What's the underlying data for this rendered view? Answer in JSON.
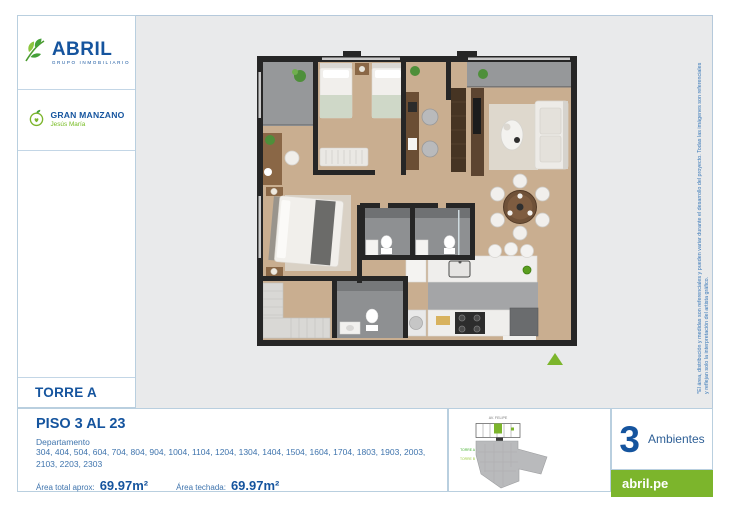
{
  "brand": {
    "name": "ABRIL",
    "tagline": "GRUPO INMOBILIARIO"
  },
  "project": {
    "name": "GRAN MANZANO",
    "district": "Jesús María"
  },
  "tower_label": "TORRE A",
  "unit": {
    "floors": "PISO 3 AL 23",
    "department_label": "Departamento",
    "departments": "304, 404, 504, 604, 704, 804, 904, 1004, 1104, 1204, 1304, 1404, 1504, 1604, 1704, 1803, 1903, 2003, 2103, 2203, 2303",
    "area_total_label": "Área total aprox:",
    "area_total": "69.97m²",
    "area_roofed_label": "Área techada:",
    "area_roofed": "69.97m²"
  },
  "ambientes": {
    "count": "3",
    "label": "Ambientes"
  },
  "site_plan": {
    "street": "AV. FELIPE",
    "tower_a": "TORRE A",
    "tower_b": "TORRE B"
  },
  "website": "abril.pe",
  "disclaimer": "*El área, distribución y medidas son referenciales y pueden variar durante el desarrollo del proyecto. Todas las imágenes son referenciales y reflejan solo la interpretación del artista gráfico.",
  "colors": {
    "brand_blue": "#15549e",
    "brand_green": "#7cb52c",
    "text_blue": "#3f74ad",
    "frame_gray": "#e9eaeb"
  }
}
